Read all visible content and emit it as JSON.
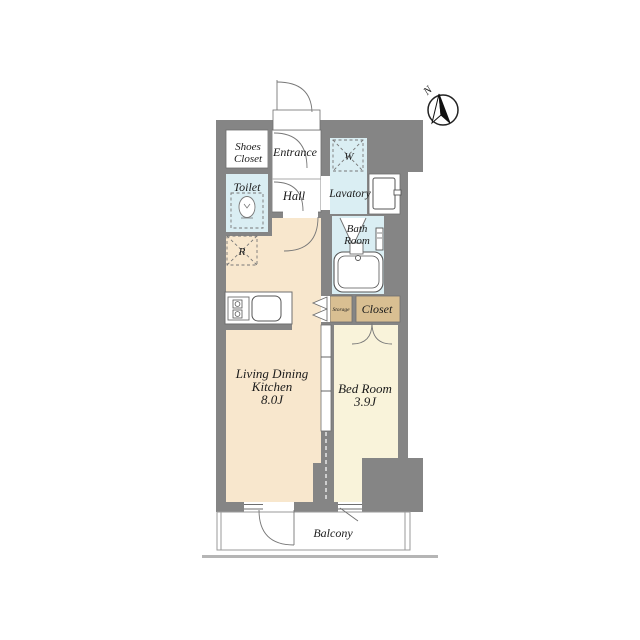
{
  "colors": {
    "wall": "#858585",
    "ground": "#b5b5b5",
    "room_ldk": "#f8e7cd",
    "room_bedroom": "#f9f3da",
    "room_wet": "#daeef3",
    "room_closet": "#d9bf92",
    "room_white": "#ffffff",
    "needle": "#111111"
  },
  "labels": {
    "compass_n": "N",
    "shoes_closet": [
      "Shoes",
      "Closet"
    ],
    "entrance": "Entrance",
    "toilet": "Toilet",
    "hall": "Hall",
    "lavatory": "Lavatory",
    "washing_machine": "W",
    "refrigerator": "R",
    "bath_room": [
      "Bath",
      "Room"
    ],
    "storage": "Storage",
    "closet": "Closet",
    "living_dining_kitchen": [
      "Living Dining",
      "Kitchen",
      "8.0J"
    ],
    "bed_room": [
      "Bed Room",
      "3.9J"
    ],
    "balcony": "Balcony"
  }
}
